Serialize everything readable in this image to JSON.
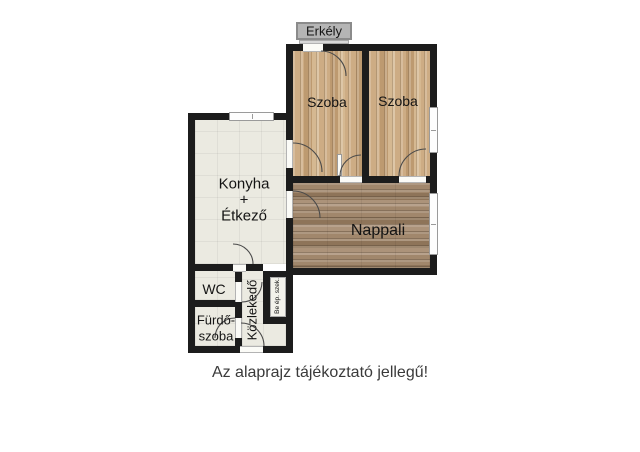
{
  "caption": "Az alaprajz tájékoztató jellegű!",
  "rooms": {
    "erkely": {
      "label": "Erkély"
    },
    "szoba_left": {
      "label": "Szoba"
    },
    "szoba_right": {
      "label": "Szoba"
    },
    "konyha": {
      "label_lines": [
        "Konyha",
        "+",
        "Étkező"
      ]
    },
    "nappali": {
      "label": "Nappali"
    },
    "wc": {
      "label": "WC"
    },
    "furdoszoba": {
      "label_lines": [
        "Fürdő-",
        "szoba"
      ]
    },
    "kozlekedo": {
      "label": "Közlekedő"
    },
    "beepitett_szekreny": {
      "label": "Be ép. szek."
    }
  },
  "colors": {
    "wall": "#1c1c1c",
    "bedroom_wood": "#c7a67e",
    "living_wood": "#9a8068",
    "tile": "#ebeae1",
    "balcony_gray": "#b5b5b5",
    "background": "#ffffff"
  }
}
